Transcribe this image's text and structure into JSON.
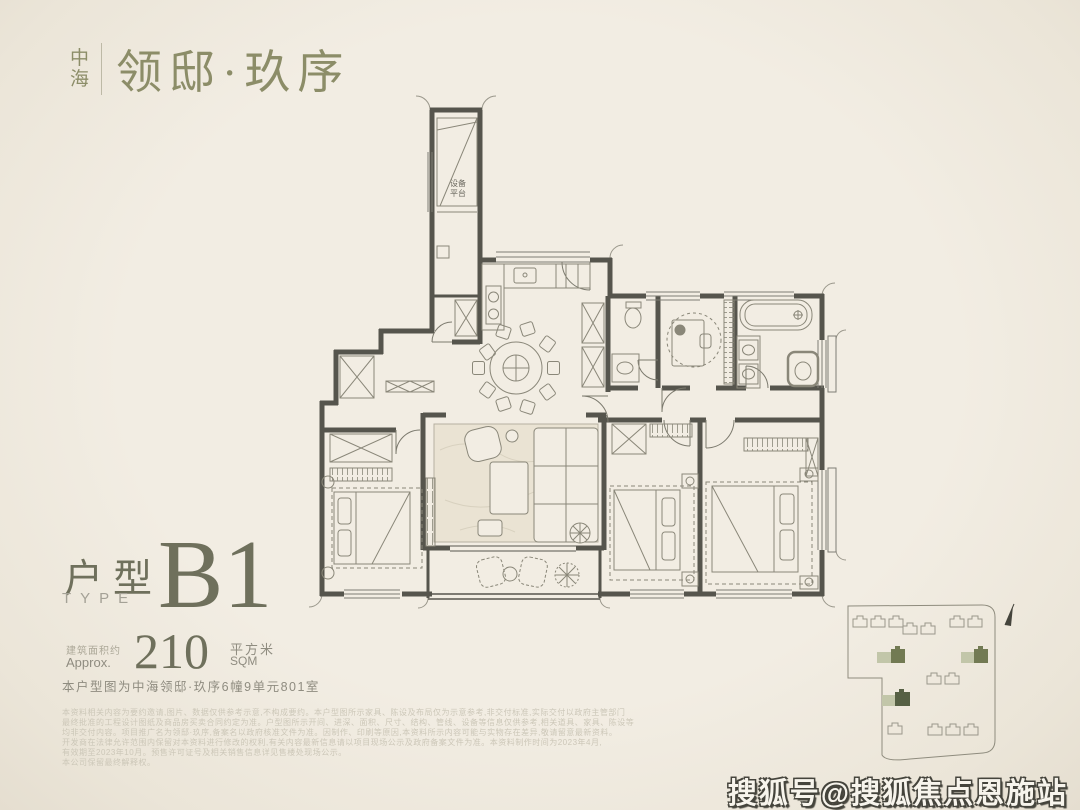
{
  "brand": {
    "stacked_top": "中",
    "stacked_bottom": "海",
    "name": "领邸·玖序"
  },
  "plan": {
    "equipment_platform_line1": "设备",
    "equipment_platform_line2": "平台"
  },
  "unit": {
    "type_cn": "户型",
    "type_en": "TYPE",
    "code": "B1",
    "area_label_cn": "建筑面积约",
    "area_label_en": "Approx.",
    "area_value": "210",
    "area_unit_cn": "平方米",
    "area_unit_en": "SQM",
    "location_note": "本户型图为中海领邸·玖序6幢9单元801室"
  },
  "disclaimer_lines": [
    "本资料相关内容为要约邀请,图片、数据仅供参考示意,不构成要约。本户型图所示家具、陈设及布局仅为示意参考,非交付标准,实际交付以政府主管部门",
    "最终批准的工程设计图纸及商品房买卖合同约定为准。户型图所示开间、进深、面积、尺寸、结构、管线、设备等信息仅供参考,相关道具、家具、陈设等",
    "均非交付内容。项目推广名为领邸·玖序,备案名以政府核准文件为准。因制作、印刷等原因,本资料所示内容可能与实物存在差异,敬请留意最新资料。",
    "开发商在法律允许范围内保留对本资料进行修改的权利,有关内容最新信息请以项目现场公示及政府备案文件为准。本资料制作时间为2023年4月,",
    "有效期至2023年10月。预售许可证号及相关销售信息详见售楼处现场公示。",
    "本公司保留最终解释权。"
  ],
  "watermark": "搜狐号@搜狐焦点恩施站",
  "colors": {
    "background": "#f2ede3",
    "wall": "#56554d",
    "furniture_line": "#8a8779",
    "accent_olive": "#8c8d68",
    "text_olive": "#6f705c",
    "site_green_light": "#c2c6a9",
    "site_green_dark": "#727a53"
  }
}
